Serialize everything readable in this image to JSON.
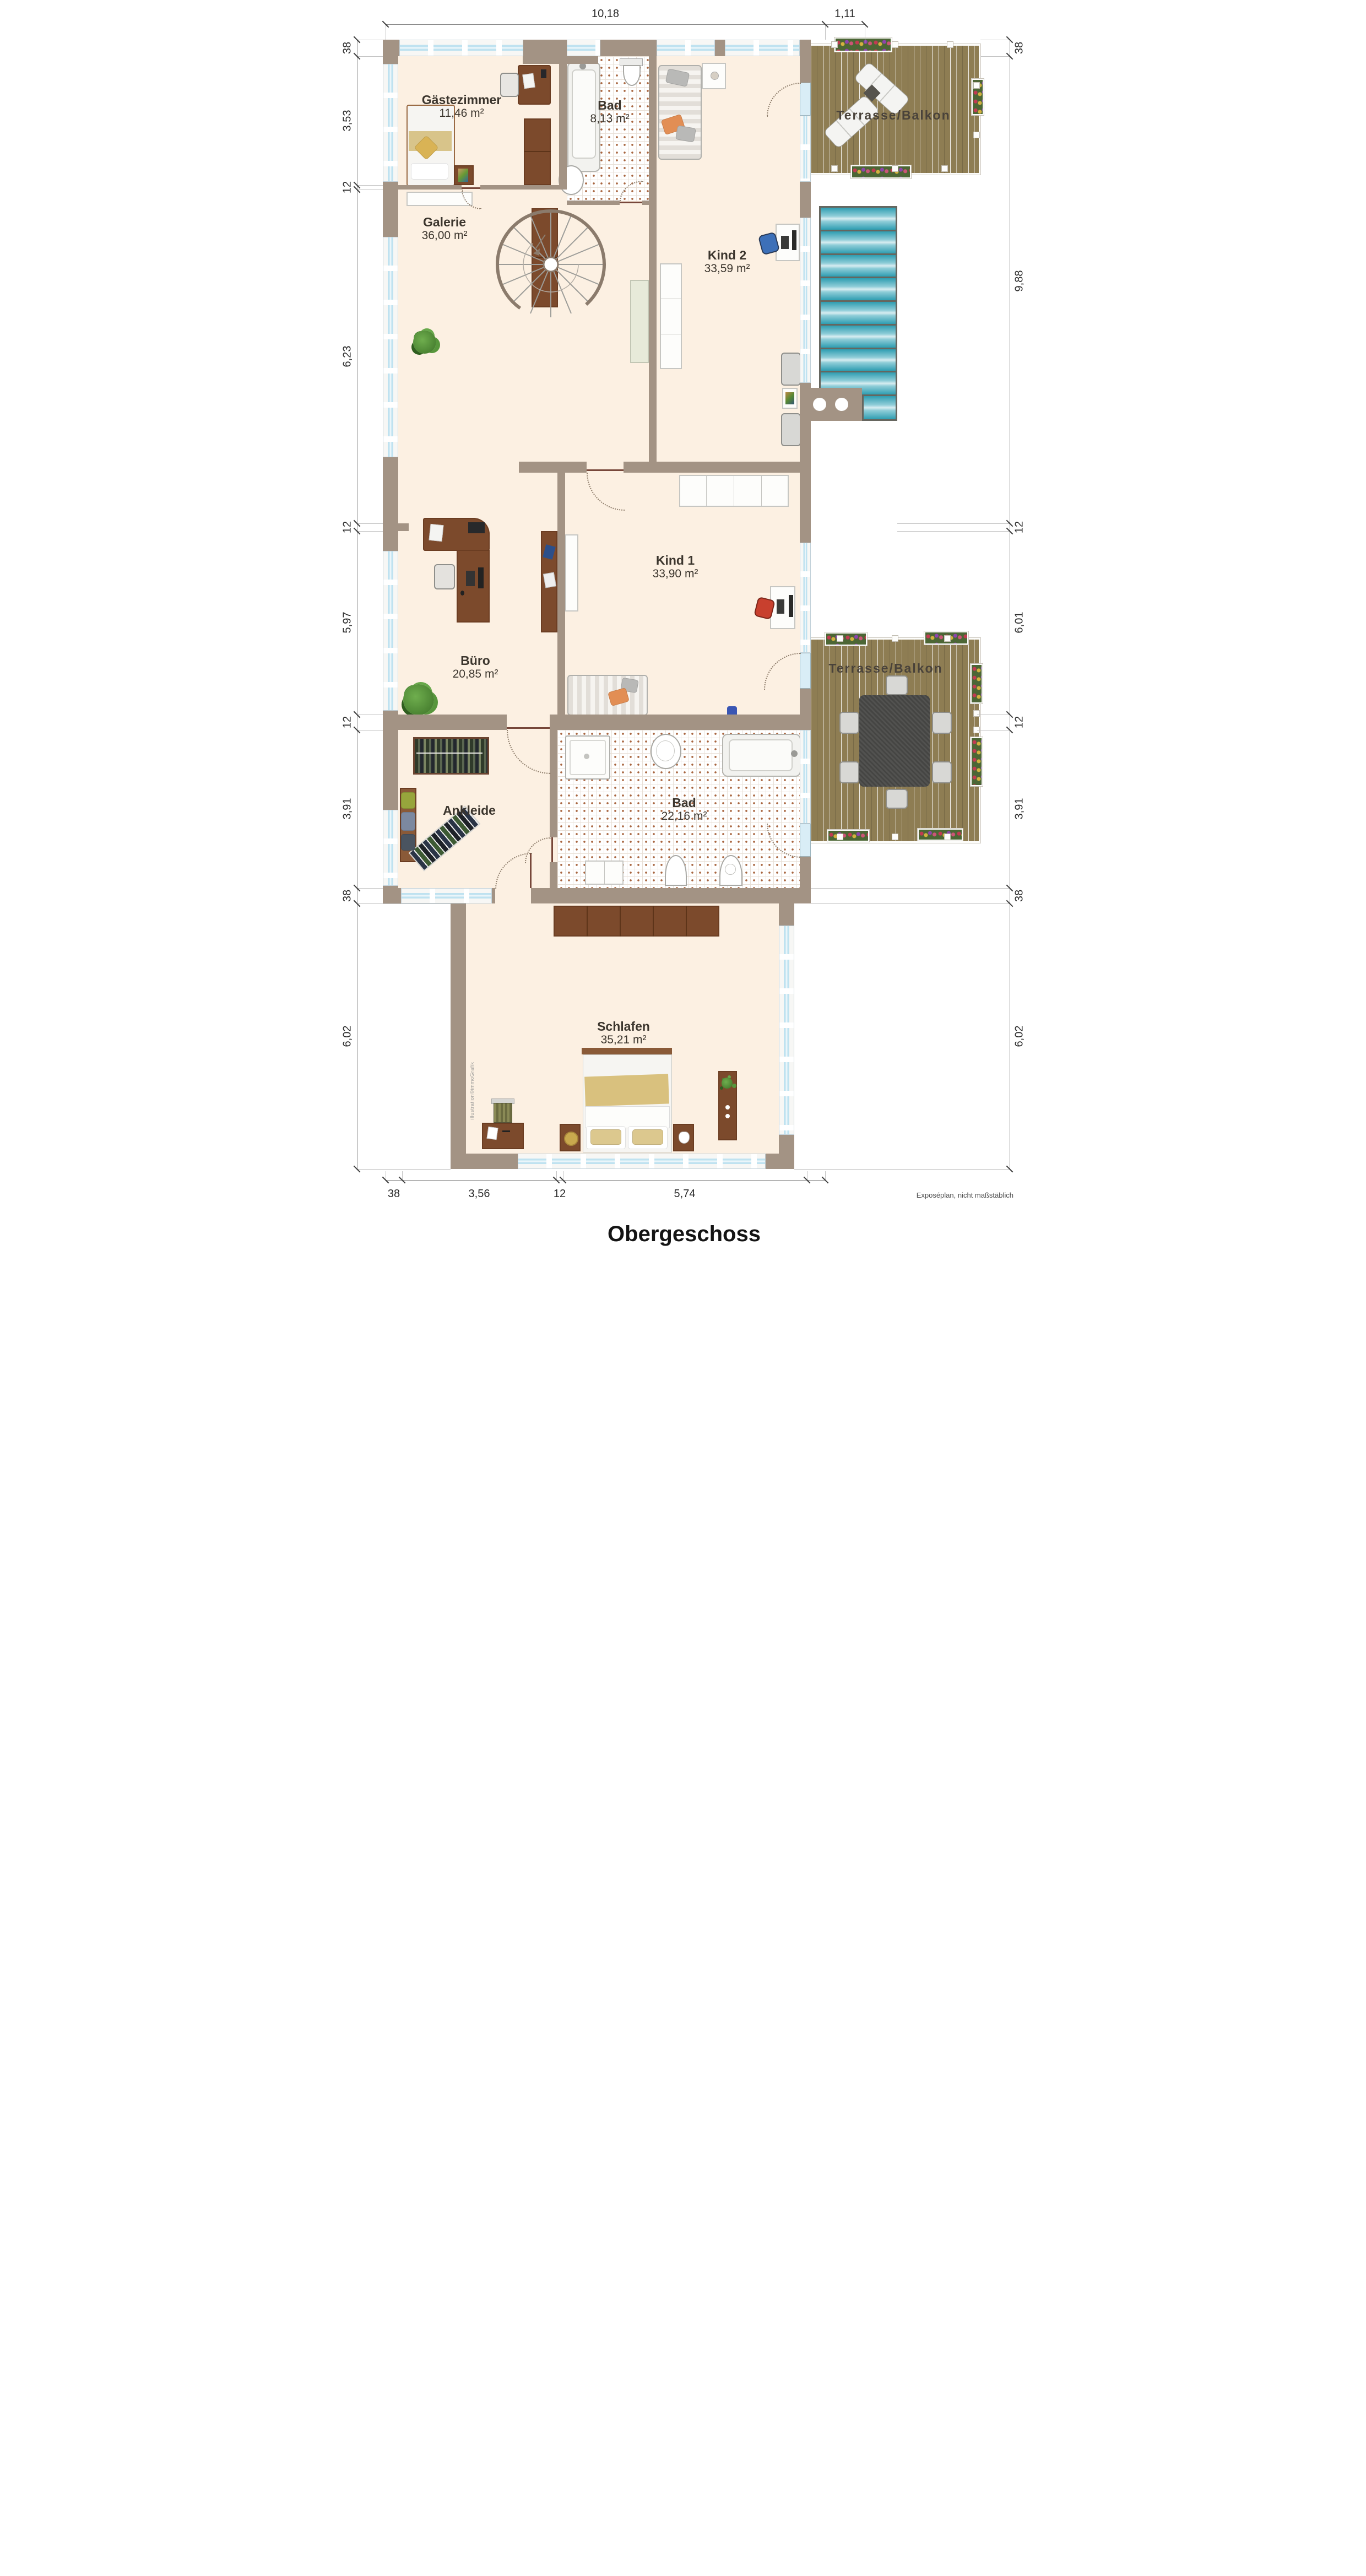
{
  "meta": {
    "title": "Obergeschoss",
    "disclaimer": "Exposéplan, nicht maßstäblich",
    "watermark": "illustration©immoGrafik"
  },
  "rooms": {
    "gaestezimmer": {
      "name": "Gästezimmer",
      "area": "11,46 m²"
    },
    "bad_og": {
      "name": "Bad",
      "area": "8,13 m²"
    },
    "kind2": {
      "name": "Kind 2",
      "area": "33,59 m²"
    },
    "galerie": {
      "name": "Galerie",
      "area": "36,00 m²"
    },
    "terrasse_oben": {
      "name": "Terrasse/Balkon"
    },
    "kind1": {
      "name": "Kind 1",
      "area": "33,90 m²"
    },
    "buero": {
      "name": "Büro",
      "area": "20,85 m²"
    },
    "ankleide": {
      "name": "Ankleide"
    },
    "bad_ug": {
      "name": "Bad",
      "area": "22,16 m²"
    },
    "terrasse_unten": {
      "name": "Terrasse/Balkon"
    },
    "schlafen": {
      "name": "Schlafen",
      "area": "35,21 m²"
    }
  },
  "dimensions": {
    "top": [
      "10,18",
      "1,11"
    ],
    "bottom": [
      "38",
      "3,56",
      "12",
      "5,74"
    ],
    "left": [
      "38",
      "3,53",
      "12",
      "6,23",
      "12",
      "5,97",
      "12",
      "3,91",
      "38",
      "6,02"
    ],
    "right": [
      "38",
      "9,88",
      "12",
      "6,01",
      "12",
      "3,91",
      "38",
      "6,02"
    ]
  },
  "colors": {
    "wall": "#a39384",
    "floor": "#fcf0e2",
    "skylight": "#2e9db1",
    "deck": "#8e7d53",
    "window": "#bfe2f0"
  }
}
